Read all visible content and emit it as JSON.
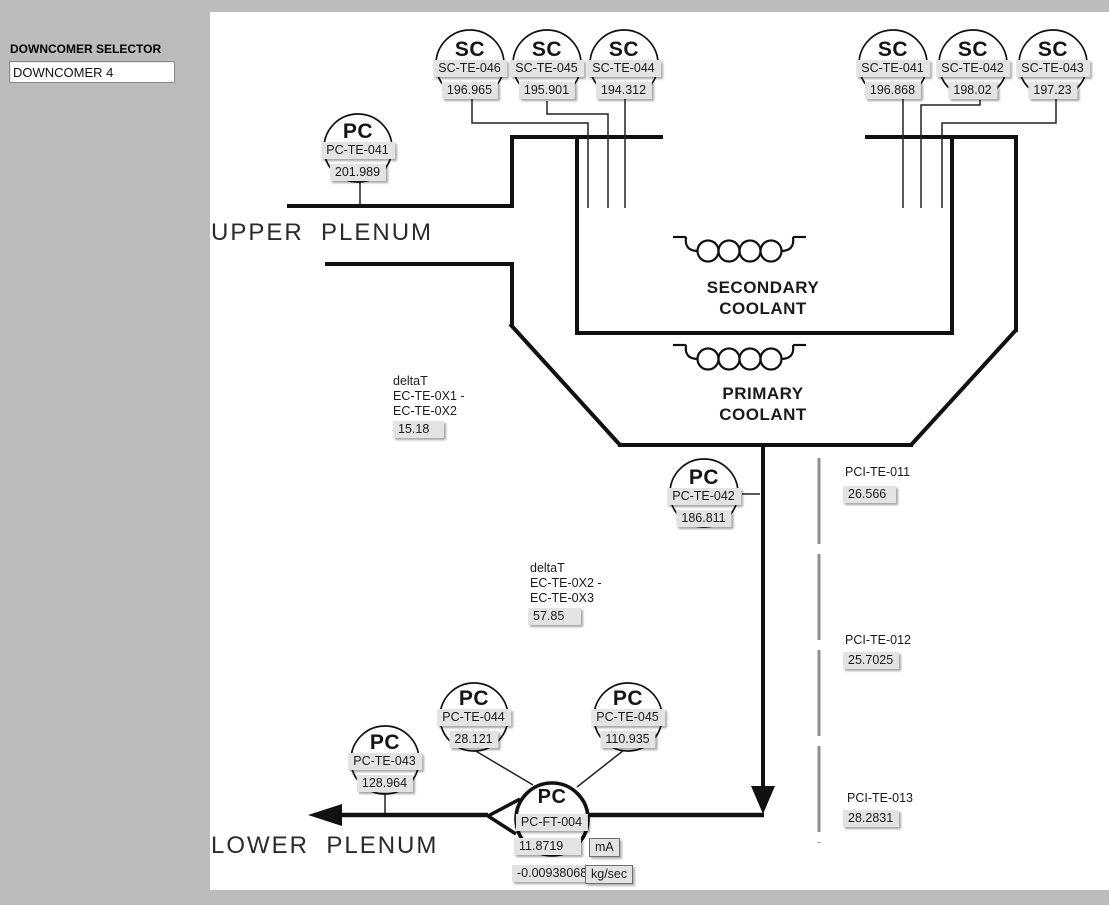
{
  "selector": {
    "label": "DOWNCOMER SELECTOR",
    "value": "DOWNCOMER 4"
  },
  "diagram": {
    "upper_plenum": "UPPER  PLENUM",
    "lower_plenum": "LOWER  PLENUM",
    "secondary_coolant_line1": "SECONDARY",
    "secondary_coolant_line2": "COOLANT",
    "primary_coolant_line1": "PRIMARY",
    "primary_coolant_line2": "COOLANT"
  },
  "instruments": [
    {
      "type": "SC",
      "tag": "SC-TE-046",
      "value": "196.965"
    },
    {
      "type": "SC",
      "tag": "SC-TE-045",
      "value": "195.901"
    },
    {
      "type": "SC",
      "tag": "SC-TE-044",
      "value": "194.312"
    },
    {
      "type": "SC",
      "tag": "SC-TE-041",
      "value": "196.868"
    },
    {
      "type": "SC",
      "tag": "SC-TE-042",
      "value": "198.02"
    },
    {
      "type": "SC",
      "tag": "SC-TE-043",
      "value": "197.23"
    },
    {
      "type": "PC",
      "tag": "PC-TE-041",
      "value": "201.989"
    },
    {
      "type": "PC",
      "tag": "PC-TE-042",
      "value": "186.811"
    },
    {
      "type": "PC",
      "tag": "PC-TE-044",
      "value": "28.121"
    },
    {
      "type": "PC",
      "tag": "PC-TE-045",
      "value": "110.935"
    },
    {
      "type": "PC",
      "tag": "PC-TE-043",
      "value": "128.964"
    }
  ],
  "pci_sensors": [
    {
      "tag": "PCI-TE-011",
      "value": "26.566"
    },
    {
      "tag": "PCI-TE-012",
      "value": "25.7025"
    },
    {
      "tag": "PCI-TE-013",
      "value": "28.2831"
    }
  ],
  "delta_t": [
    {
      "lines": [
        "deltaT",
        "EC-TE-0X1 -",
        "EC-TE-0X2"
      ],
      "value": "15.18"
    },
    {
      "lines": [
        "deltaT",
        "EC-TE-0X2 -",
        "EC-TE-0X3"
      ],
      "value": "57.85"
    }
  ],
  "flow_transmitter": {
    "type": "PC",
    "tag": "PC-FT-004",
    "current": "11.8719",
    "current_unit": "mA",
    "flow": "-0.00938068",
    "flow_unit": "kg/sec"
  },
  "colors": {
    "background": "#bcbcbc",
    "canvas": "#ffffff",
    "ink": "#111111",
    "box": "#e3e3e3",
    "dashed_line": "#8f8f8f"
  }
}
